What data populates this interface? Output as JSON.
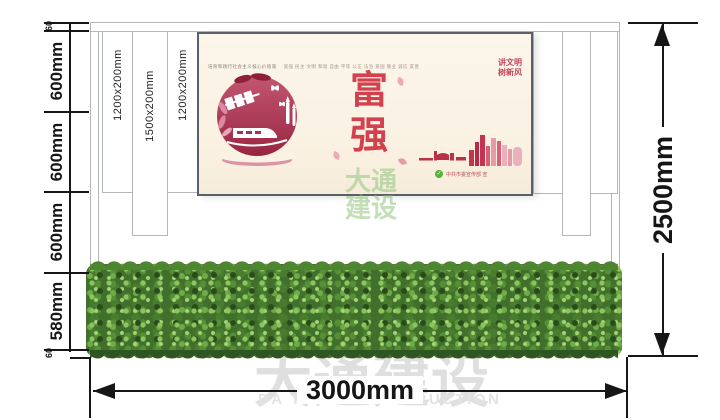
{
  "drawing": {
    "type": "signage-construction-elevation"
  },
  "dimensions": {
    "left_segments": [
      "60",
      "600mm",
      "600mm",
      "600mm",
      "580mm",
      "60"
    ],
    "total_width": "3000mm",
    "total_height": "2500mm"
  },
  "columns": {
    "labels": [
      "1200x200mm",
      "1500x200mm",
      "1200x200mm"
    ]
  },
  "poster": {
    "values_title": "培育和践行社会主义核心价值观",
    "values_list": "富强 民主 文明 和谐 自由 平等 公正 法治 爱国 敬业 诚信 友善",
    "slogan_line1": "讲文明",
    "slogan_line2": "树新风",
    "char_top": "富",
    "char_bottom": "强",
    "attribution_icon": "check-icon",
    "attribution": "中共市委宣传部 宣"
  },
  "watermark": {
    "cn": "大通建设",
    "en": "DA TONG CONSTRUCTION",
    "small_line1": "大通",
    "small_line2": "建设"
  },
  "colors": {
    "poster_background": "#faf2e4",
    "accent_red": "#d4414e",
    "circle_crimson": "#a83050",
    "hedge_green": "#4a7c2f",
    "watermark_gray": "#dfdfdf",
    "watermark_green": "#92c47e",
    "dimension_black": "#161616"
  }
}
